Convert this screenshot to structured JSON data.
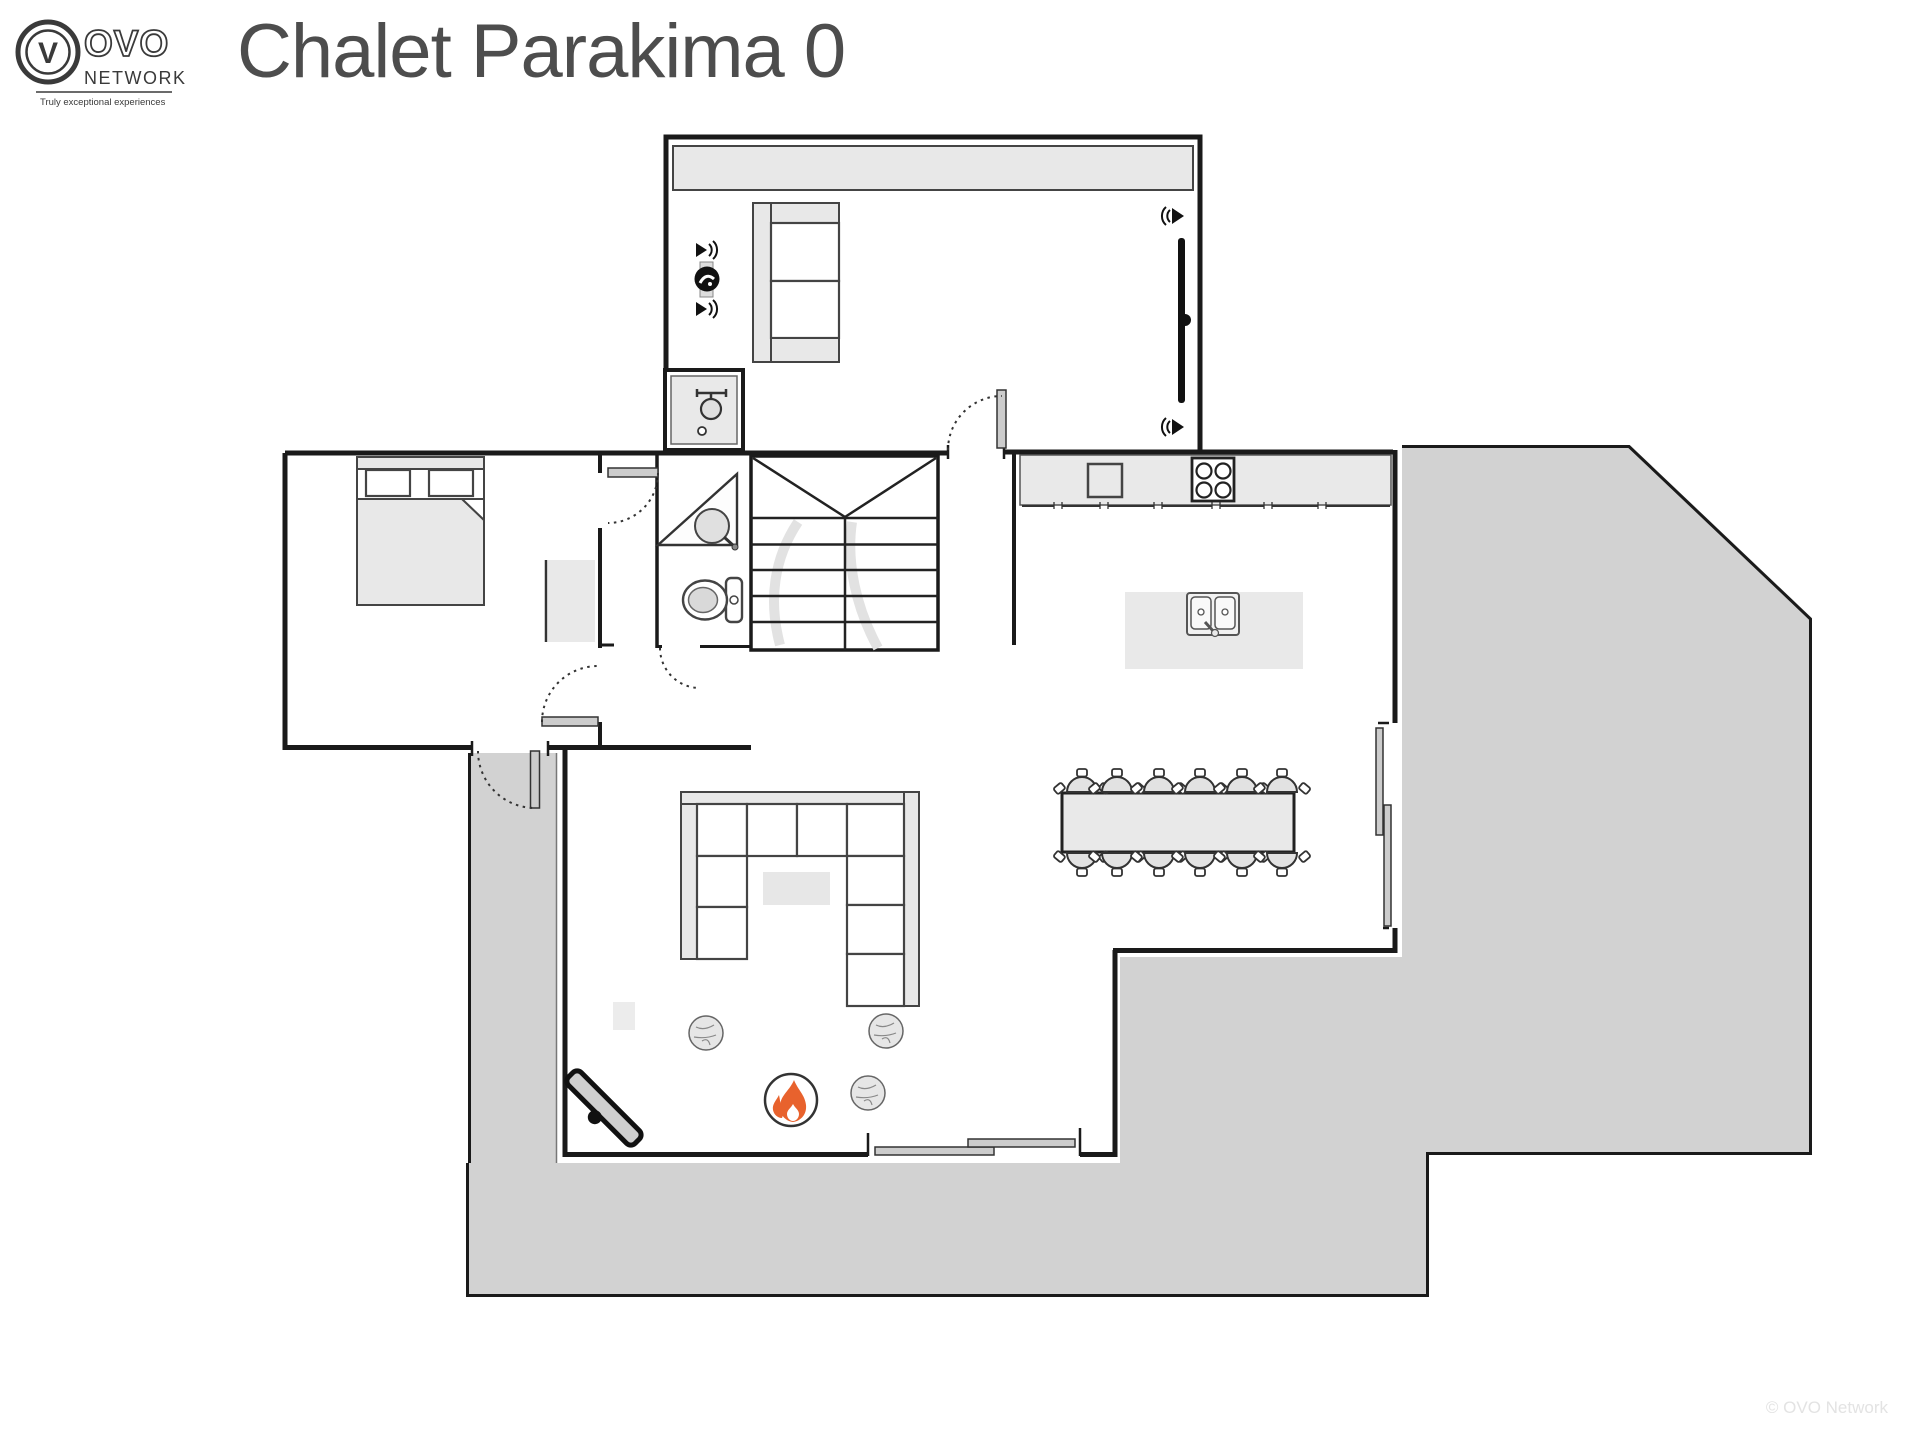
{
  "header": {
    "title": "Chalet Parakima 0",
    "logo": {
      "monogram": "V",
      "line1": "OVO",
      "line2": "NETWORK",
      "tagline": "Truly exceptional experiences"
    }
  },
  "footer": {
    "watermark": "© OVO Network"
  },
  "colors": {
    "wall": "#1a1a1a",
    "terrace": "#d2d2d2",
    "furn": "#e8e8e8",
    "outline": "#444444",
    "door_leaf": "#cccccc",
    "flame": "#e8622d",
    "title_text": "#4d4d4d",
    "logo_text": "#3a3a3a",
    "watermark_text": "#e3e3e3"
  },
  "plan": {
    "floor": "0",
    "rooms": [
      {
        "name": "balcony-lounge",
        "features": [
          "bench-strip",
          "two-seat-sofa",
          "wall-tv",
          "speakers"
        ]
      },
      {
        "name": "bedroom",
        "features": [
          "double-bed",
          "dresser"
        ]
      },
      {
        "name": "shower-room",
        "features": [
          "shower"
        ]
      },
      {
        "name": "bathroom",
        "features": [
          "corner-sink",
          "toilet"
        ]
      },
      {
        "name": "staircase",
        "features": [
          "double-flight-stairs"
        ]
      },
      {
        "name": "kitchen",
        "features": [
          "counter",
          "hob",
          "island-double-sink"
        ]
      },
      {
        "name": "dining-area",
        "features": [
          "table-12-chairs",
          "sliding-door"
        ]
      },
      {
        "name": "living-room",
        "features": [
          "u-sofa",
          "coffee-table",
          "fireplace",
          "poufs",
          "bench",
          "sliding-door"
        ]
      },
      {
        "name": "terrace",
        "features": [
          "wrap-around-deck",
          "entry-porch"
        ]
      }
    ],
    "inventory": {
      "dining_chairs": 12,
      "poufs": 3,
      "speakers_left": 2,
      "speakers_tv": 2,
      "sofa_cushions_living": 9
    },
    "icons": {
      "flame-icon": "fireplace flame glyph",
      "speaker-icon": "audio speaker with sound waves",
      "shower-icon": "shower head top view",
      "sink-icon": "round basin with tap",
      "toilet-icon": "toilet top view",
      "hob-icon": "4-ring cooktop",
      "media-icon": "round media device"
    }
  }
}
